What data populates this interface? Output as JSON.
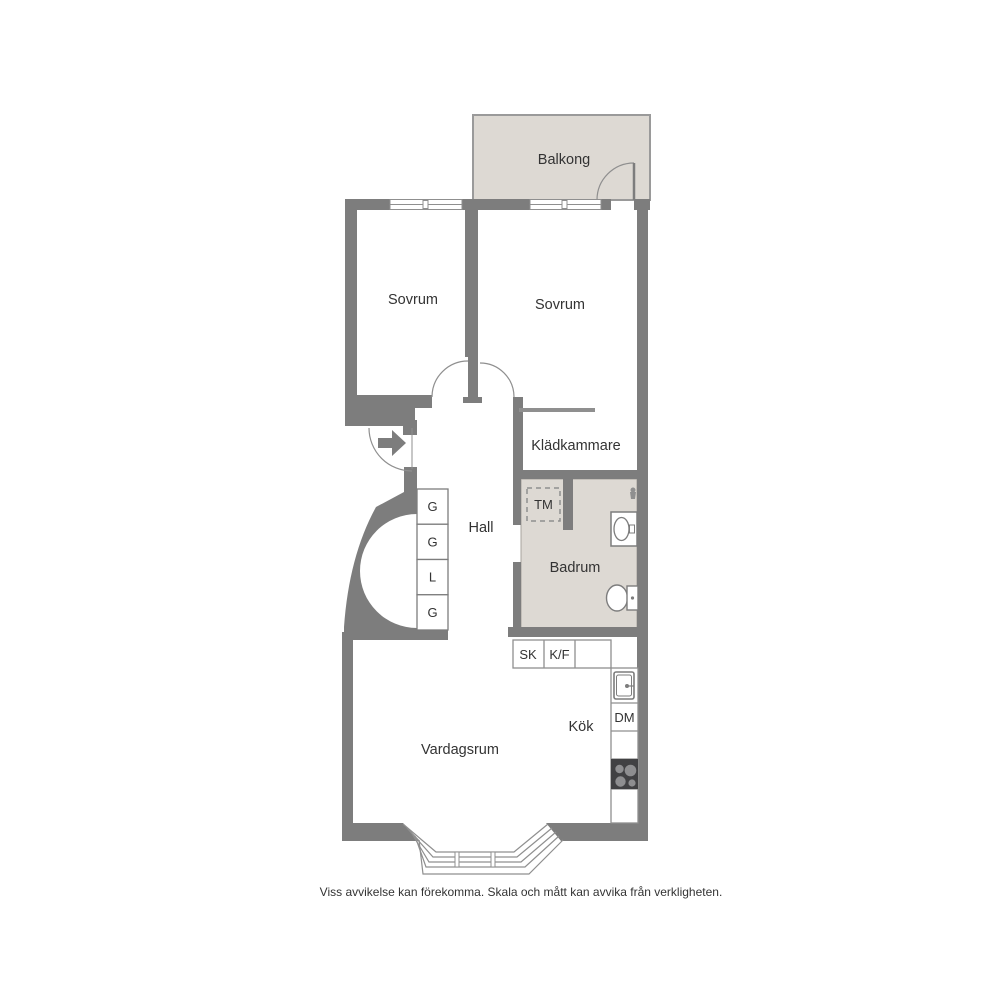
{
  "plan": {
    "rooms": {
      "balkong": "Balkong",
      "sovrum_left": "Sovrum",
      "sovrum_right": "Sovrum",
      "kladkammare": "Klädkammare",
      "hall": "Hall",
      "badrum": "Badrum",
      "kok": "Kök",
      "vardagsrum": "Vardagsrum"
    },
    "fixtures": {
      "tm": "TM",
      "sk": "SK",
      "kf": "K/F",
      "dm": "DM"
    },
    "closets": [
      "G",
      "G",
      "L",
      "G"
    ],
    "icons": {
      "entry": "arrow-right-icon",
      "bathroom": [
        "washbasin-icon",
        "toilet-icon",
        "shower-mixer-icon"
      ],
      "kitchen": [
        "kitchen-sink-icon",
        "stove-icon"
      ],
      "windows": "double-line-window",
      "doors": "quarter-arc-door"
    },
    "colors": {
      "wall": "#7d7d7d",
      "floor": "#ffffff",
      "balcony_fill": "#ddd9d3",
      "bathroom_fill": "#ddd9d3",
      "thin_line": "#8f8f8f",
      "stove": "#414143",
      "burner": "#8e8e90",
      "text": "#333333"
    },
    "footer": "Viss avvikelse kan förekomma. Skala och mått kan avvika från verkligheten."
  }
}
